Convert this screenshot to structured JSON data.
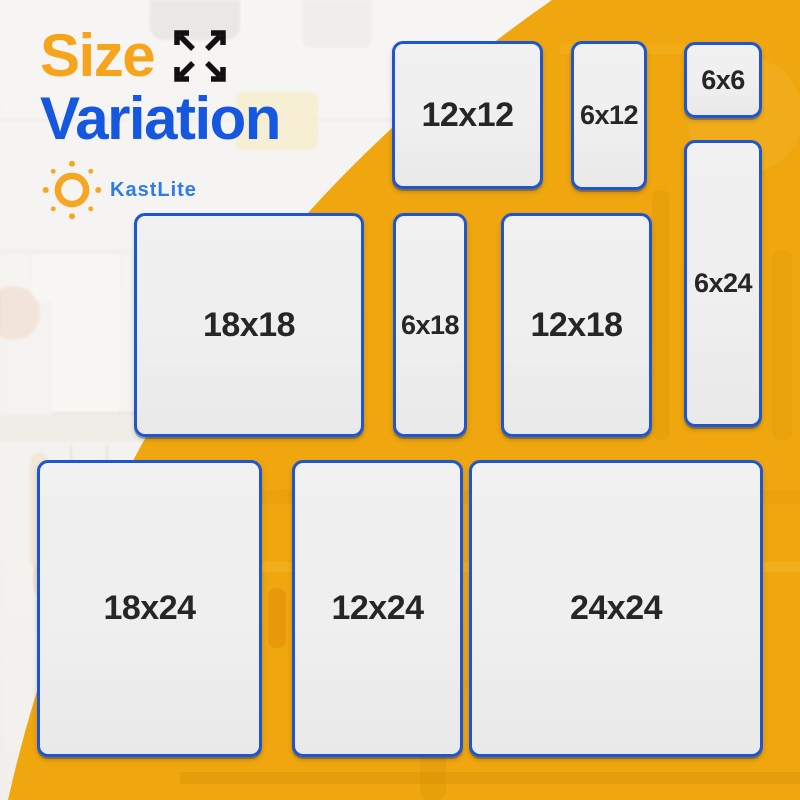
{
  "page": {
    "width": 800,
    "height": 800
  },
  "header": {
    "title_word1": "Size",
    "title_word2": "Variation",
    "brand_name": "KastLite"
  },
  "icons": [
    {
      "name": "expand-arrows-icon",
      "meaning": "four arrows pointing outward from center (size/expand)"
    },
    {
      "name": "sun-icon",
      "meaning": "KastLite brand sun logo: orange ring surrounded by dots"
    }
  ],
  "colors": {
    "title_word1": "#F5A41C",
    "title_word2": "#1557DF",
    "brand_text": "#2E7CE4",
    "sun": "#F5A623",
    "swoosh_yellow": "#EFA60F",
    "box_fill": "#EFEFEF",
    "box_border": "#1E55D0",
    "box_label": "#262626",
    "arrows_icon": "#111111"
  },
  "sizes_shown": [
    "12x12",
    "6x12",
    "6x6",
    "6x24",
    "18x18",
    "6x18",
    "12x18",
    "18x24",
    "12x24",
    "24x24"
  ],
  "boxes": [
    {
      "label": "12x12",
      "x": 392,
      "y": 41,
      "w": 151,
      "h": 148
    },
    {
      "label": "6x12",
      "x": 571,
      "y": 41,
      "w": 76,
      "h": 149
    },
    {
      "label": "6x6",
      "x": 684,
      "y": 42,
      "w": 78,
      "h": 76
    },
    {
      "label": "6x24",
      "x": 684,
      "y": 140,
      "w": 78,
      "h": 287
    },
    {
      "label": "18x18",
      "x": 134,
      "y": 213,
      "w": 230,
      "h": 224
    },
    {
      "label": "6x18",
      "x": 393,
      "y": 213,
      "w": 74,
      "h": 224
    },
    {
      "label": "12x18",
      "x": 501,
      "y": 213,
      "w": 151,
      "h": 224
    },
    {
      "label": "18x24",
      "x": 37,
      "y": 460,
      "w": 225,
      "h": 297
    },
    {
      "label": "12x24",
      "x": 292,
      "y": 460,
      "w": 171,
      "h": 297
    },
    {
      "label": "24x24",
      "x": 469,
      "y": 460,
      "w": 294,
      "h": 297
    }
  ]
}
